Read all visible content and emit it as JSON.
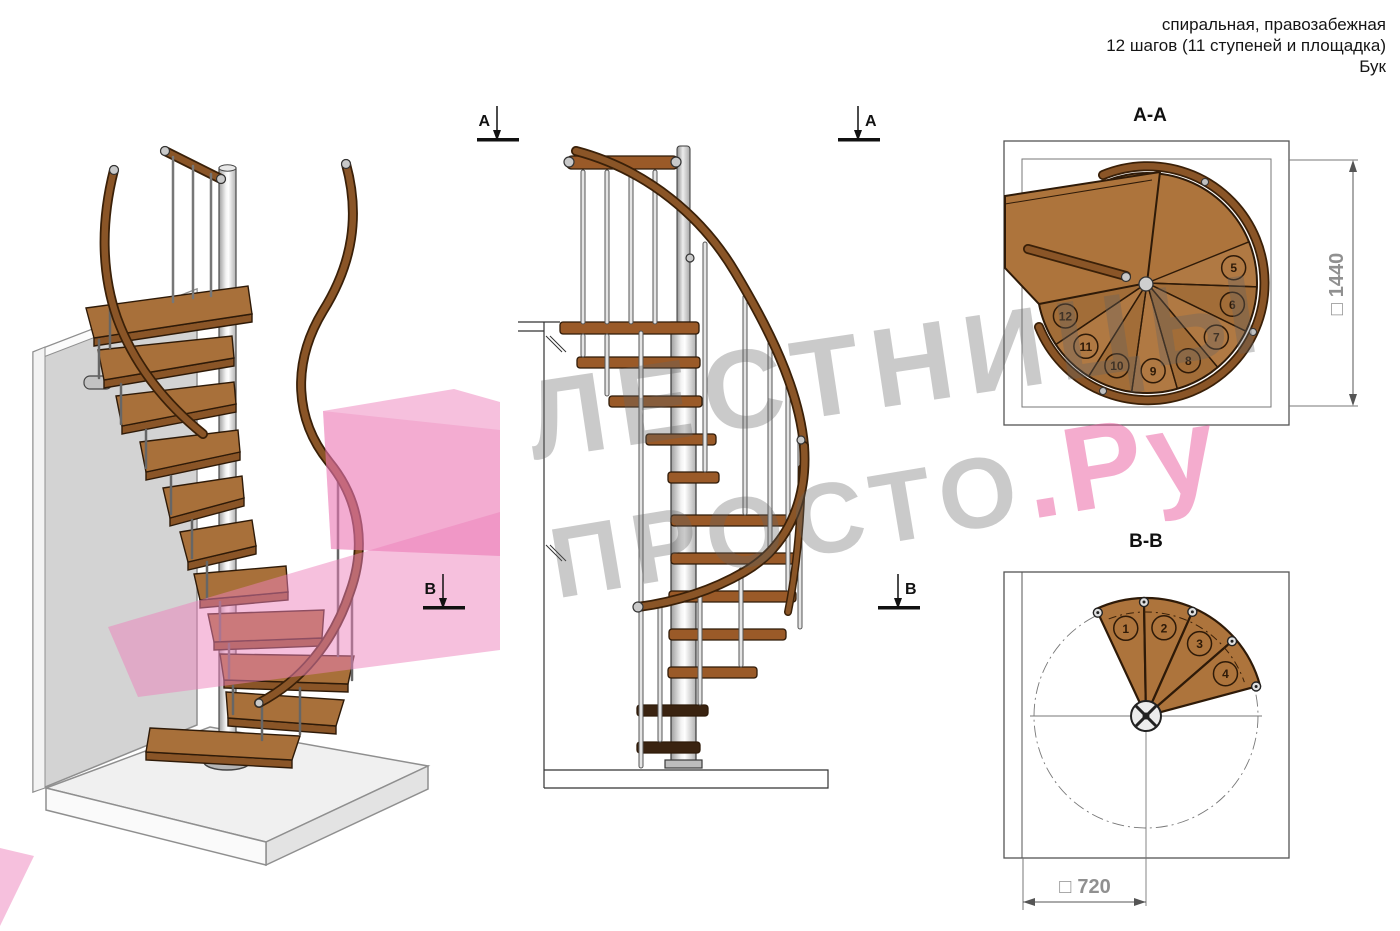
{
  "annotation": {
    "line1": "спиральная, правозабежная",
    "line2": "12 шагов (11 ступеней и площадка)",
    "line3": "Бук"
  },
  "watermark": {
    "line1": "ЛЕСТНИЦЫ",
    "line2_gray": "ПРОСТО",
    "line2_pink": ".Ру",
    "gray_color": "#b5b5b5",
    "pink_color": "#ee6ea8"
  },
  "views": {
    "elevation": {
      "section_marker_a": "А",
      "section_marker_b": "В"
    },
    "aa": {
      "title": "А-А",
      "step_numbers": [
        "5",
        "6",
        "7",
        "8",
        "9",
        "10",
        "11",
        "12"
      ],
      "dimension": {
        "symbol": "□",
        "value": "1440"
      }
    },
    "bb": {
      "title": "В-В",
      "step_numbers": [
        "1",
        "2",
        "3",
        "4"
      ],
      "dimension": {
        "symbol": "□",
        "value": "720"
      }
    }
  },
  "colors": {
    "wood": "#ad743c",
    "wood_dark": "#6b3d16",
    "rail": "#8a5527",
    "rail_outline": "#3a2008",
    "metal": "#c9c9c9",
    "wall": "#d3d3d3",
    "floor": "#f0f0f0",
    "highlight_pink": "#f2a4cd",
    "dim_text": "#909090"
  }
}
